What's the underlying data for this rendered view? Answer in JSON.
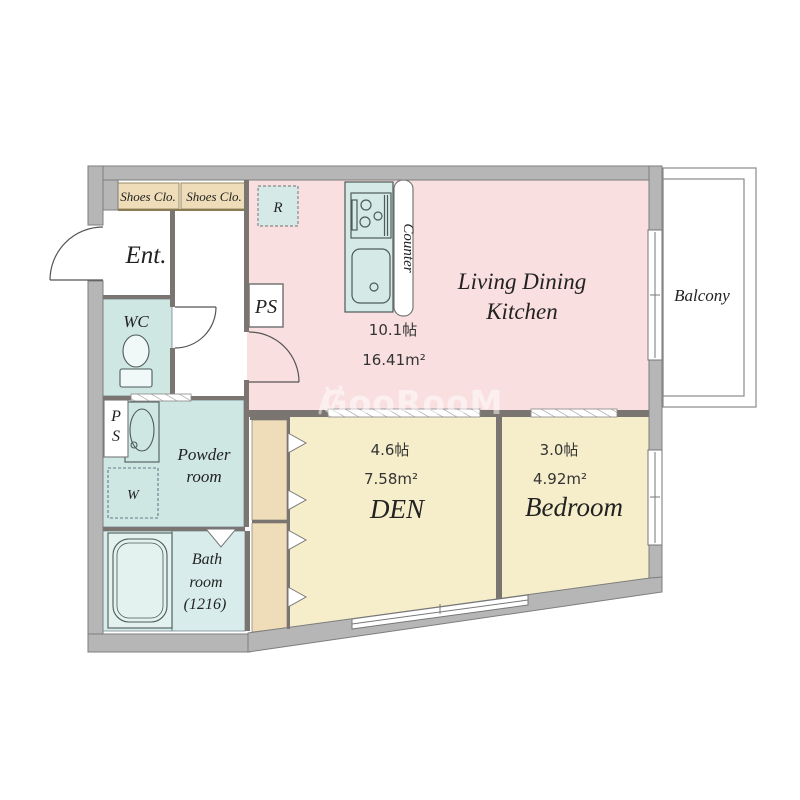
{
  "plan_title": "apartment-floor-plan",
  "rooms": {
    "ldk": {
      "line1": "Living Dining",
      "line2": "Kitchen",
      "area_jo": "10.1帖",
      "area_m2": "16.41m²"
    },
    "den": {
      "name": "DEN",
      "area_jo": "4.6帖",
      "area_m2": "7.58m²"
    },
    "bedroom": {
      "name": "Bedroom",
      "area_jo": "3.0帖",
      "area_m2": "4.92m²"
    },
    "entrance": {
      "name": "Ent."
    },
    "wc": {
      "name": "WC"
    },
    "powder": {
      "line1": "Powder",
      "line2": "room"
    },
    "bathroom": {
      "line1": "Bath",
      "line2": "room",
      "line3": "(1216)"
    },
    "balcony": {
      "name": "Balcony"
    },
    "shoes_closet_1": {
      "name": "Shoes Clo."
    },
    "shoes_closet_2": {
      "name": "Shoes Clo."
    }
  },
  "fixtures": {
    "refrigerator": "R",
    "pipe_space_top": "PS",
    "pipe_space_left_line1": "P",
    "pipe_space_left_line2": "S",
    "washer": "W",
    "counter": "Counter"
  },
  "watermark": {
    "text": "GooRooM"
  },
  "colors": {
    "ldk_pink": "#f9dfdf",
    "room_yellow": "#f6eecb",
    "closet_tan": "#efddb9",
    "wet_area_mint": "#cfe7e3",
    "bath_mint": "#d8edeb",
    "wall_gray": "#b6b6b6",
    "inner_wall": "#7a7570"
  }
}
